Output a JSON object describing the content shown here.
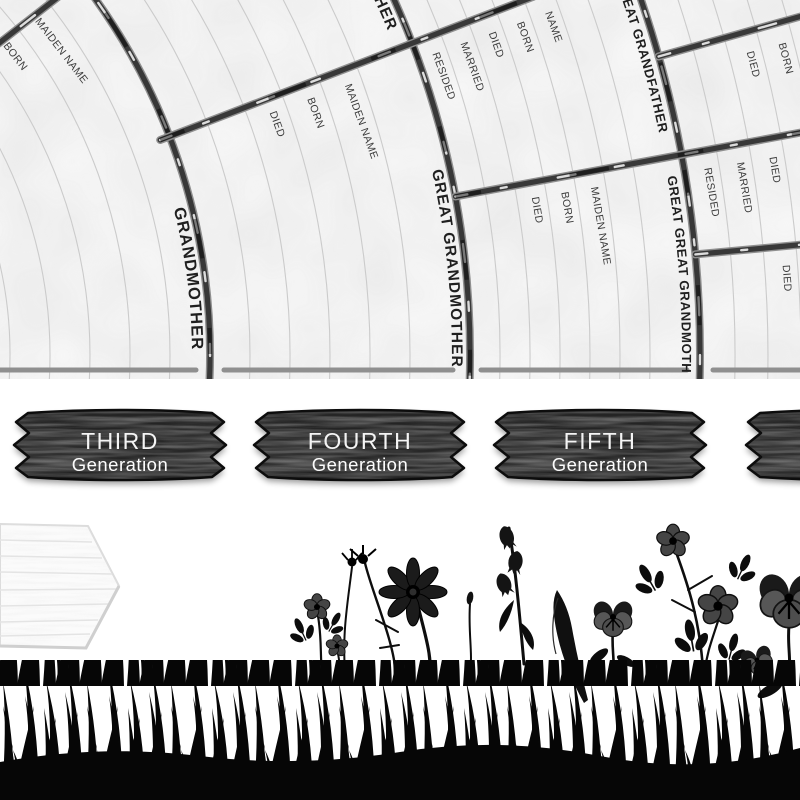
{
  "fan": {
    "sector_labels": {
      "grandmother": "GRANDMOTHER",
      "great_grandmother": "GREAT GRANDMOTHER",
      "great_grandfather": "GREAT GRANDFATHER",
      "great_great_grandfather": "GREAT GREAT GRANDFATHER",
      "great_great_grandmother": "GREAT GREAT GRANDMOTHER"
    },
    "field_labels": {
      "name": "NAME",
      "born": "BORN",
      "died": "DIED",
      "married": "MARRIED",
      "resided": "RESIDED",
      "maiden_name": "MAIDEN NAME"
    }
  },
  "signs": {
    "generations": [
      {
        "ordinal": "THIRD",
        "word": "Generation"
      },
      {
        "ordinal": "FOURTH",
        "word": "Generation"
      },
      {
        "ordinal": "FIFTH",
        "word": "Generation"
      },
      {
        "ordinal": "SIXTH",
        "word": "Generation"
      }
    ]
  },
  "colors": {
    "paper": "#f7f7f7",
    "ruling_line": "#cbcbcb",
    "branch_outline": "#8f8f8f",
    "branch_core": "#383838",
    "label_text": "#1f1f1f",
    "field_text": "#3c3c3c",
    "plaque_wood": "#242424",
    "plaque_text": "#f4f4f4",
    "silhouette": "#060606",
    "arrow_sign_wood": "#fbfbfb"
  }
}
